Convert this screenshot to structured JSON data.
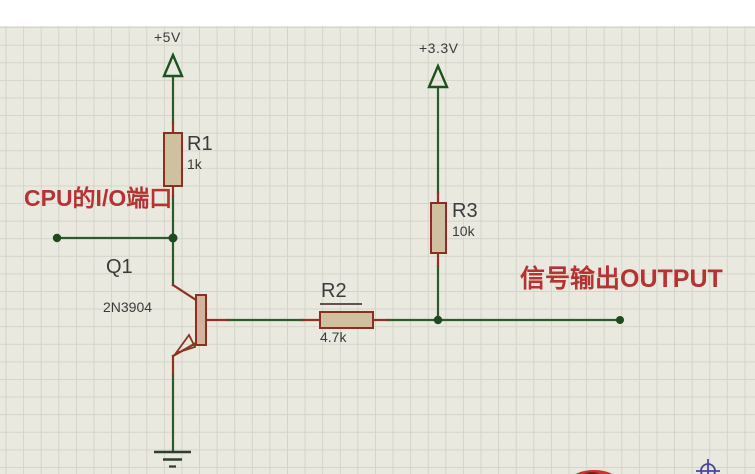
{
  "annotations": {
    "cpu_port": "CPU的I/O端口",
    "signal_output": "信号输出OUTPUT"
  },
  "power": {
    "vcc5": "+5V",
    "vcc33": "+3.3V"
  },
  "components": {
    "r1": {
      "ref": "R1",
      "value": "1k"
    },
    "r2": {
      "ref": "R2",
      "value": "4.7k"
    },
    "r3": {
      "ref": "R3",
      "value": "10k"
    },
    "q1": {
      "ref": "Q1",
      "model": "2N3904"
    }
  },
  "colors": {
    "wire": "#2d5a2d",
    "pin": "#8e3322",
    "component_fill": "#cfc0a0",
    "component_outline": "#8b3020",
    "annotation": "#b53333",
    "label": "#3b3b3b",
    "power_symbol": "#1e521e",
    "ground": "#2f3f2f",
    "junction_dot": "#1f4a1f",
    "grid_background": "#eae9e0",
    "grid_line": "#d5d4c8"
  }
}
